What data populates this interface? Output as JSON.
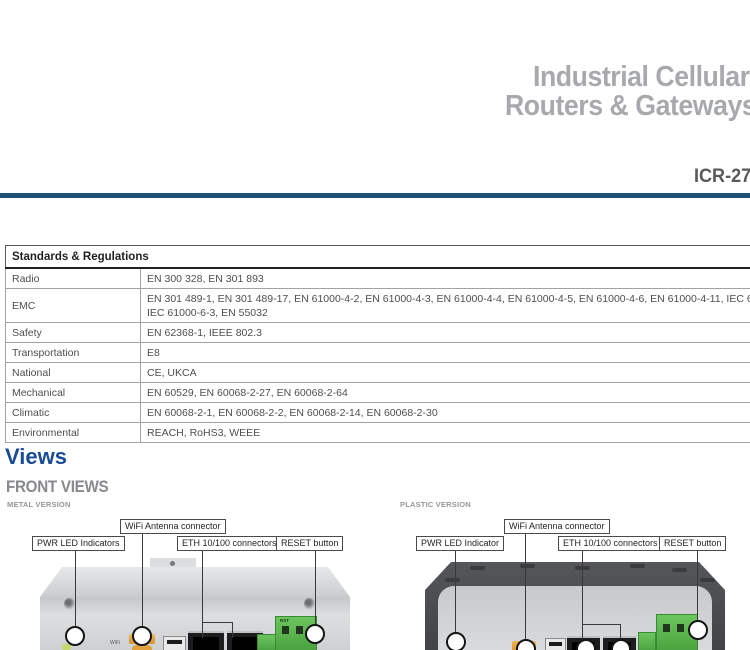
{
  "header": {
    "title_line1": "Industrial Cellular",
    "title_line2": "Routers & Gateways",
    "model": "ICR-27",
    "accent_color": "#1b4f74",
    "title_color": "#a7a9ac"
  },
  "standards": {
    "title": "Standards & Regulations",
    "rows": [
      {
        "label": "Radio",
        "value": "EN 300 328, EN 301 893"
      },
      {
        "label": "EMC",
        "value": "EN 301 489-1, EN 301 489-17, EN 61000-4-2, EN 61000-4-3, EN 61000-4-4, EN 61000-4-5, EN 61000-4-6, EN 61000-4-11, IEC 61000-6-2,",
        "value2": "IEC 61000-6-3, EN 55032"
      },
      {
        "label": "Safety",
        "value": "EN 62368-1, IEEE 802.3"
      },
      {
        "label": "Transportation",
        "value": "E8"
      },
      {
        "label": "National",
        "value": "CE, UKCA"
      },
      {
        "label": "Mechanical",
        "value": "EN 60529, EN 60068-2-27, EN 60068-2-64"
      },
      {
        "label": "Climatic",
        "value": "EN 60068-2-1, EN 60068-2-2, EN 60068-2-14, EN 60068-2-30"
      },
      {
        "label": "Environmental",
        "value": "REACH, RoHS3, WEEE"
      }
    ]
  },
  "views": {
    "section_title": "Views",
    "subsection_title": "FRONT VIEWS",
    "heading_color": "#1a4b96",
    "metal": {
      "variant_label": "METAL VERSION",
      "labels": {
        "wifi": "WiFi Antenna connector",
        "pwr": "PWR LED Indicators",
        "eth": "ETH 10/100 connectors",
        "reset": "RESET button"
      },
      "markings": {
        "wifi": "WiFi",
        "rst": "RST"
      }
    },
    "plastic": {
      "variant_label": "PLASTIC VERSION",
      "labels": {
        "wifi": "WiFi Antenna connector",
        "pwr": "PWR LED Indicator",
        "eth": "ETH 10/100 connectors",
        "reset": "RESET button"
      }
    }
  }
}
